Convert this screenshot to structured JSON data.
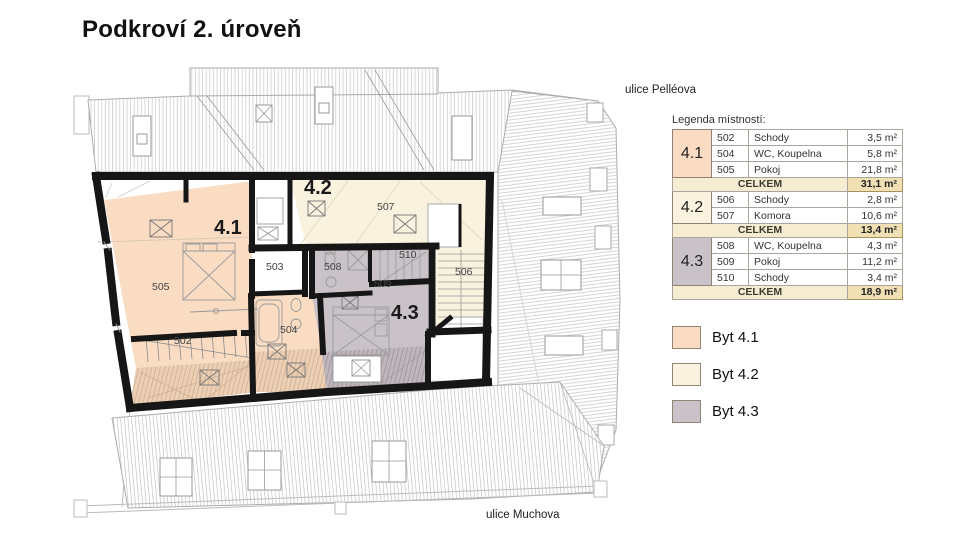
{
  "page": {
    "title": "Podkroví 2. úroveň"
  },
  "streets": {
    "top": "ulice Pelléova",
    "bottom": "ulice Muchova"
  },
  "legend": {
    "title": "Legenda místností:",
    "total_label": "CELKEM",
    "groups": [
      {
        "id": "4.1",
        "color": "#fbdcc3",
        "rooms": [
          {
            "no": "502",
            "name": "Schody",
            "area": "3,5 m²"
          },
          {
            "no": "504",
            "name": "WC, Koupelna",
            "area": "5,8 m²"
          },
          {
            "no": "505",
            "name": "Pokoj",
            "area": "21,8 m²"
          }
        ],
        "total": "31,1 m²"
      },
      {
        "id": "4.2",
        "color": "#faf3df",
        "rooms": [
          {
            "no": "506",
            "name": "Schody",
            "area": "2,8 m²"
          },
          {
            "no": "507",
            "name": "Komora",
            "area": "10,6 m²"
          }
        ],
        "total": "13,4 m²"
      },
      {
        "id": "4.3",
        "color": "#c9c2c8",
        "rooms": [
          {
            "no": "508",
            "name": "WC, Koupelna",
            "area": "4,3 m²"
          },
          {
            "no": "509",
            "name": "Pokoj",
            "area": "11,2 m²"
          },
          {
            "no": "510",
            "name": "Schody",
            "area": "3,4 m²"
          }
        ],
        "total": "18,9 m²"
      }
    ]
  },
  "apartments_key": [
    {
      "label": "Byt 4.1",
      "color": "#fbdcc3"
    },
    {
      "label": "Byt 4.2",
      "color": "#faf3df"
    },
    {
      "label": "Byt 4.3",
      "color": "#c9c2c8"
    }
  ],
  "plan": {
    "unit_labels": [
      {
        "text": "4.1",
        "x": 214,
        "y": 217
      },
      {
        "text": "4.2",
        "x": 304,
        "y": 177
      },
      {
        "text": "4.3",
        "x": 391,
        "y": 302
      }
    ],
    "room_labels": [
      {
        "text": "502",
        "x": 174,
        "y": 335
      },
      {
        "text": "503",
        "x": 266,
        "y": 261
      },
      {
        "text": "504",
        "x": 280,
        "y": 324
      },
      {
        "text": "505",
        "x": 152,
        "y": 281
      },
      {
        "text": "506",
        "x": 455,
        "y": 266
      },
      {
        "text": "507",
        "x": 377,
        "y": 201
      },
      {
        "text": "508",
        "x": 324,
        "y": 261
      },
      {
        "text": "509",
        "x": 374,
        "y": 278
      },
      {
        "text": "510",
        "x": 399,
        "y": 249
      }
    ]
  }
}
